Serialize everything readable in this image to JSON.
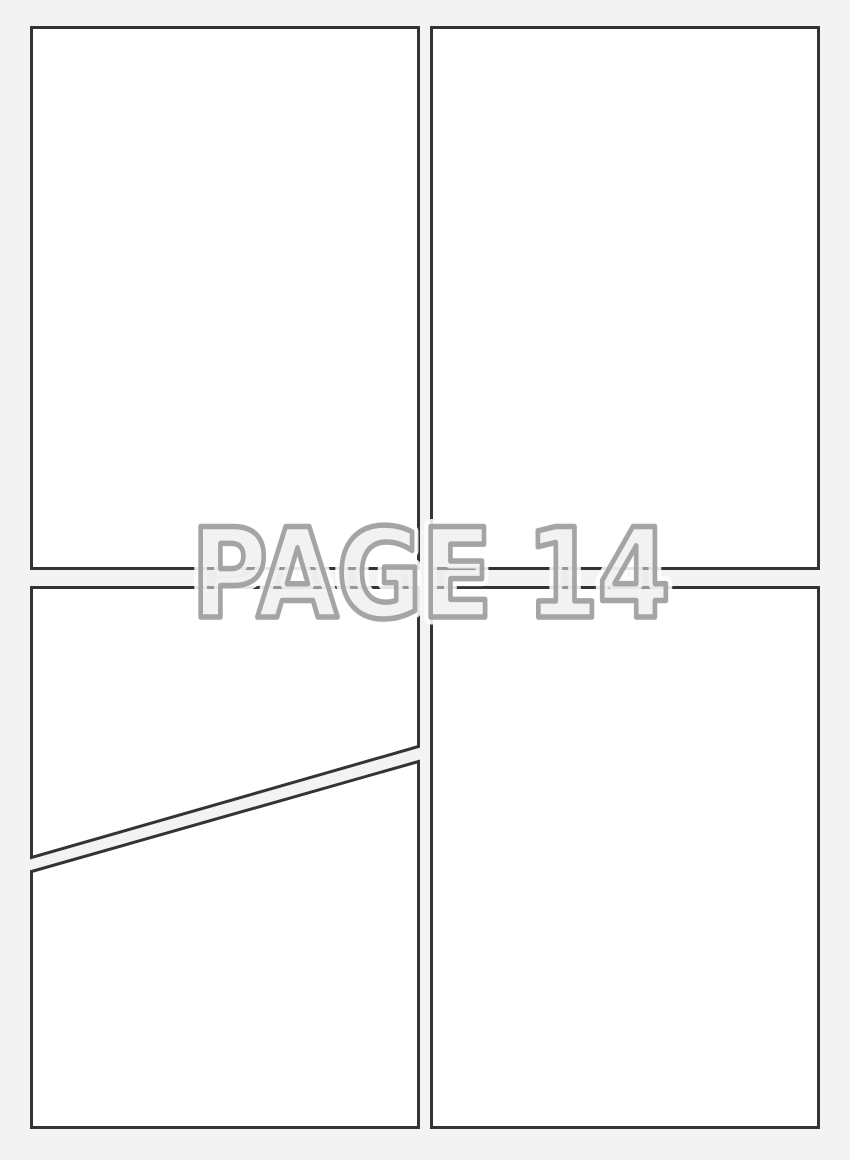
{
  "page": {
    "kind": "comic-page-template",
    "watermark": {
      "text": "PAGE 14"
    },
    "colors": {
      "background": "#f3f3f3",
      "panel_fill": "#ffffff",
      "panel_border": "#333333",
      "watermark_fill": "#e8e8e8",
      "watermark_outline": "#9e9e9e",
      "watermark_halo": "#ffffff"
    },
    "panels": [
      {
        "id": "panel-top-left",
        "shape": "rect",
        "x": 30,
        "y": 26,
        "width": 390,
        "height": 544
      },
      {
        "id": "panel-top-right",
        "shape": "rect",
        "x": 430,
        "y": 26,
        "width": 390,
        "height": 544
      },
      {
        "id": "panel-bottom-left-upper",
        "shape": "polygon",
        "points": "31.5,587.5 418.5,587.5 418.5,746.5 31.5,857.5"
      },
      {
        "id": "panel-bottom-left-lower",
        "shape": "polygon",
        "points": "31.5,871.5 418.5,761.5 418.5,1127.5 31.5,1127.5"
      },
      {
        "id": "panel-bottom-right",
        "shape": "rect",
        "x": 430,
        "y": 586,
        "width": 390,
        "height": 543
      }
    ]
  }
}
